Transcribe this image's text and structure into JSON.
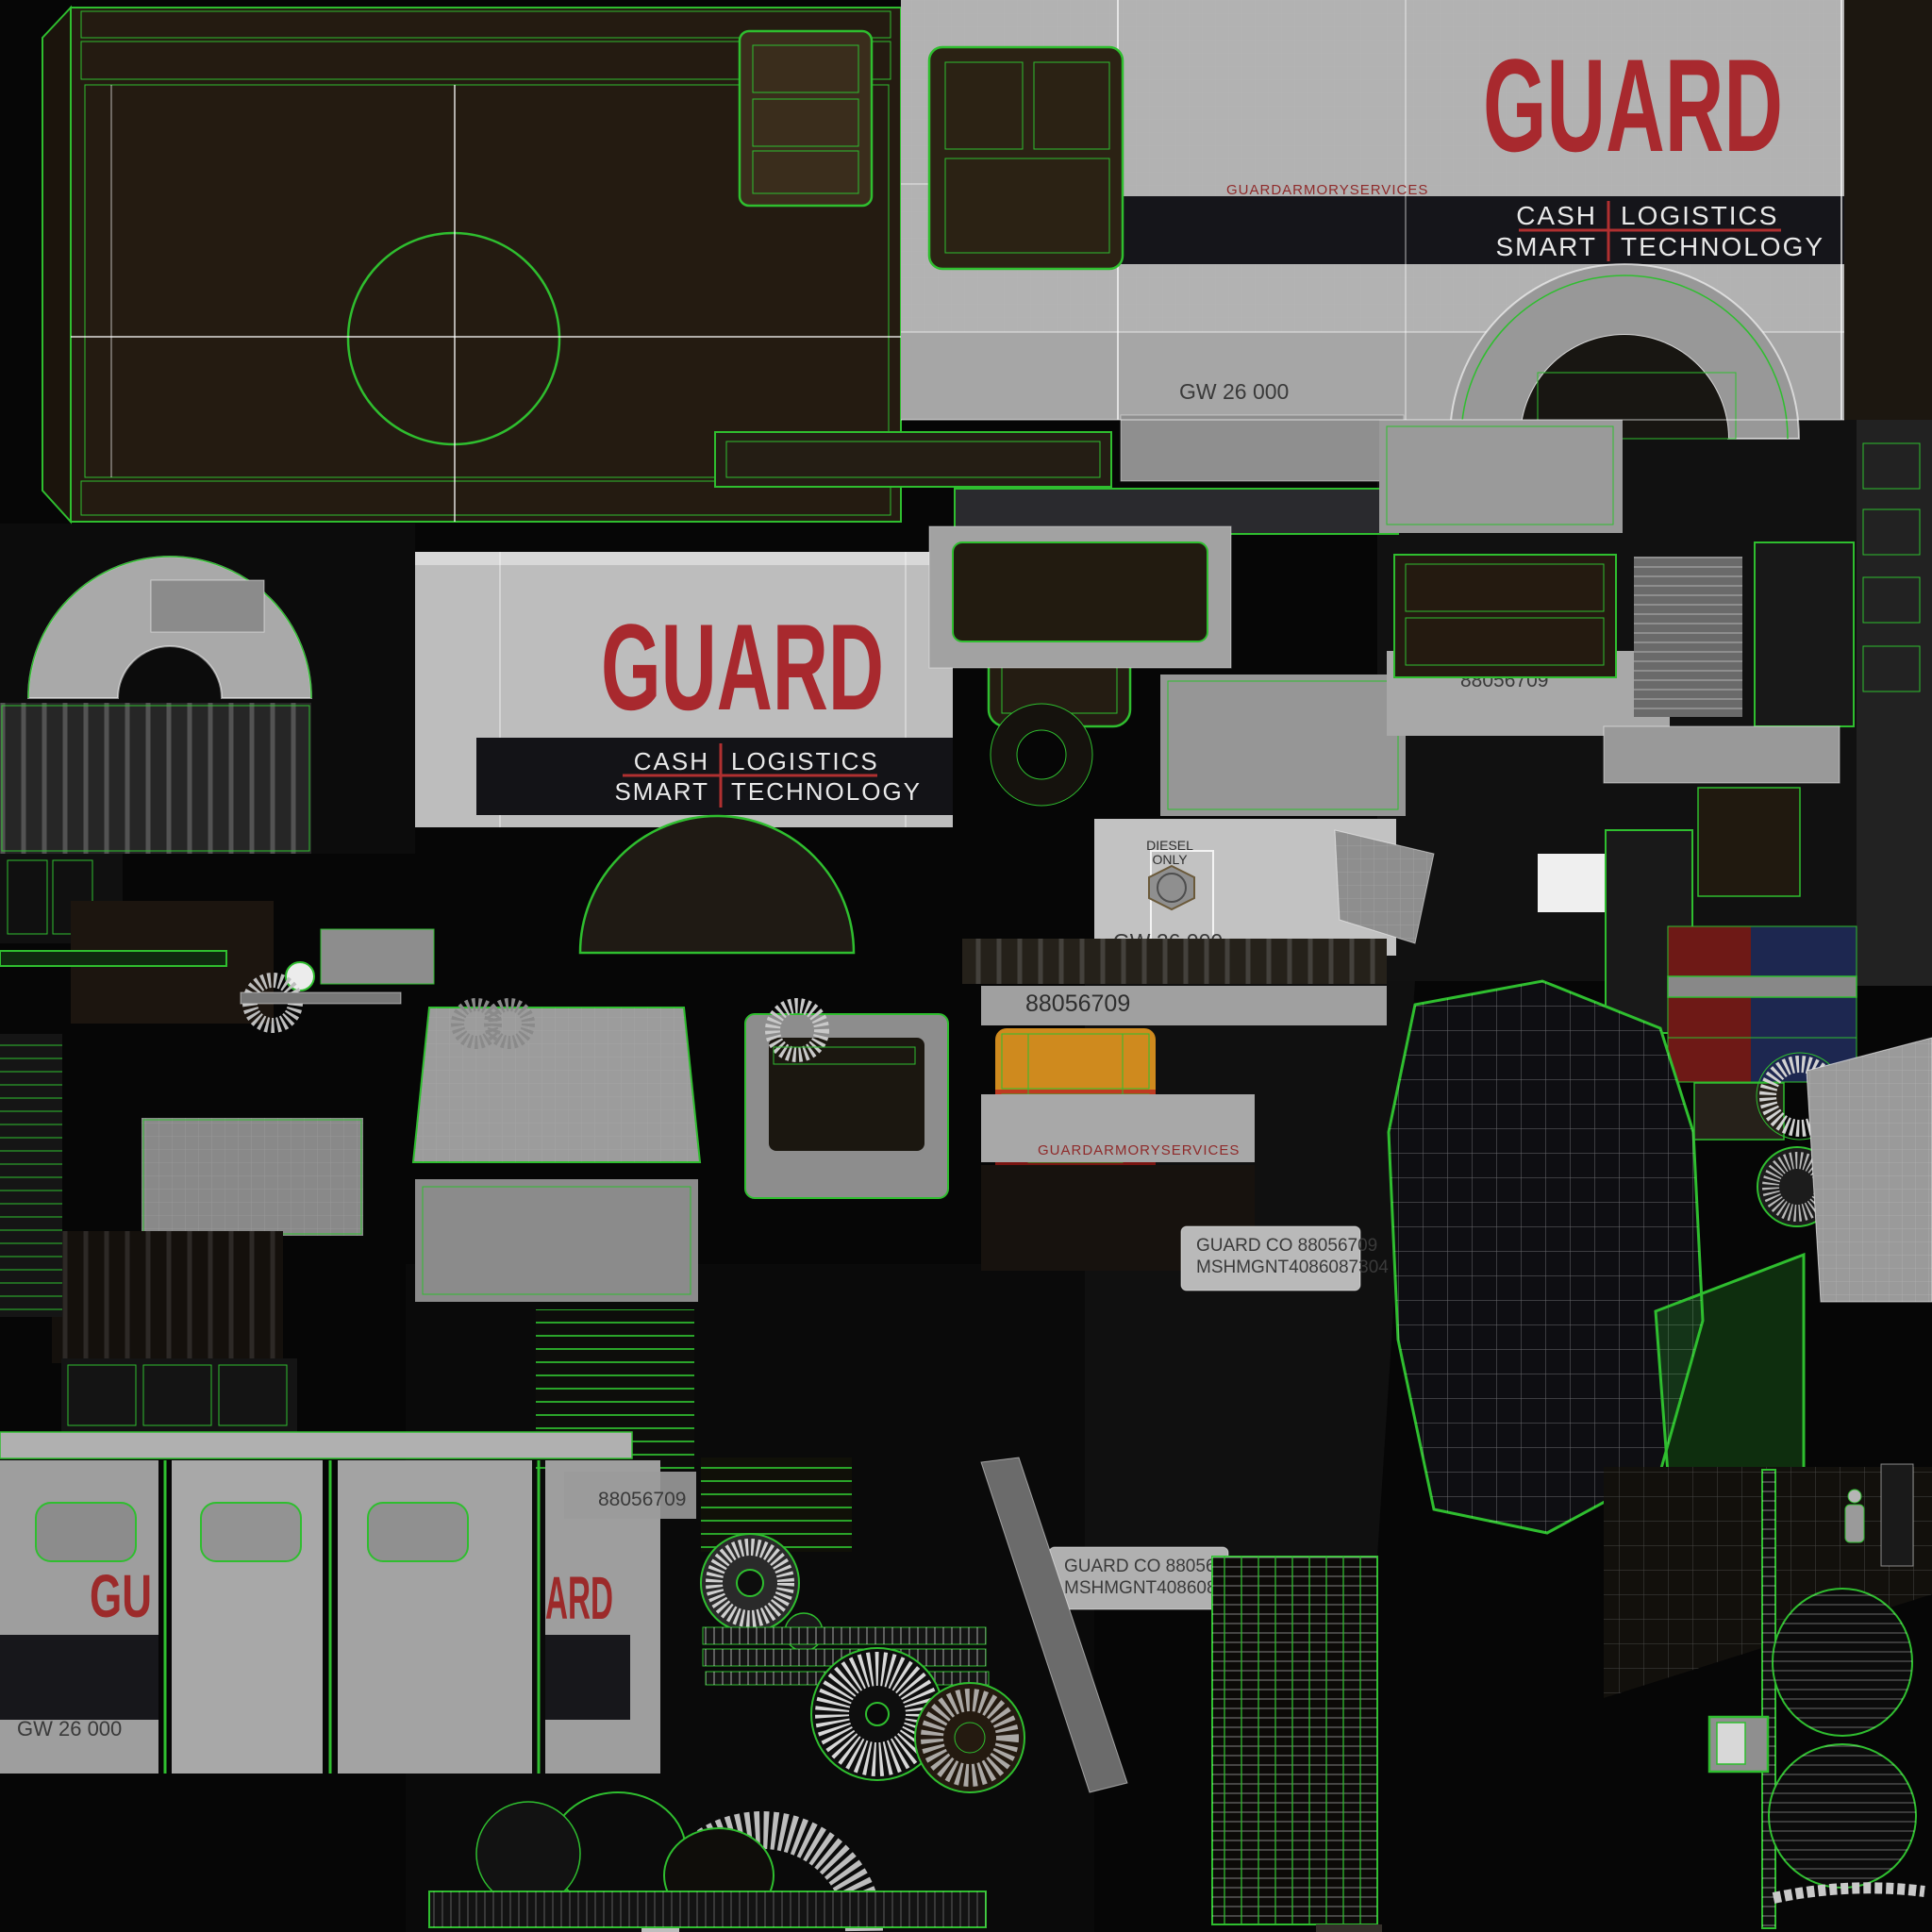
{
  "branding": {
    "logo": "GUARD",
    "logo_partial_left": "GU",
    "logo_partial_right": "ARD",
    "tagline_line1_left": "CASH",
    "tagline_line1_right": "LOGISTICS",
    "tagline_line2_left": "SMART",
    "tagline_line2_right": "TECHNOLOGY",
    "armory_services": "GUARDARMORYSERVICES"
  },
  "markings": {
    "gross_weight": "GW 26 000",
    "serial_number": "88056709",
    "guard_co_line": "GUARD CO 88056709",
    "mshmgnt_line": "MSHMGNT4086087304",
    "diesel_word": "DIESEL",
    "only_word": "ONLY"
  },
  "colors": {
    "wireframe_green": "#2fbe2f",
    "logo_red": "#a8292e",
    "tagline_divider_red": "#b03030",
    "armory_red": "#8f2b2b",
    "panel_gray": "#b6b6b6",
    "band_black": "#15151a",
    "roof_brown": "#241b11",
    "taillight_amber": "#cf8a1e",
    "taillight_red": "#bf3a20",
    "seat_red": "#6e1916",
    "seat_blue": "#1d2750"
  }
}
